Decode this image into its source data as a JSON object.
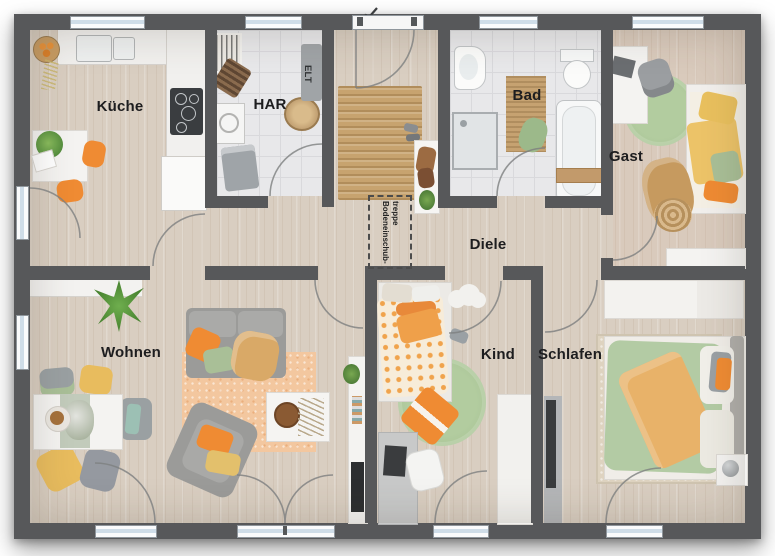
{
  "plan": {
    "type": "floor-plan-top-view",
    "rooms": {
      "kueche": "Küche",
      "har": "HAR",
      "bad": "Bad",
      "gast": "Gast",
      "diele": "Diele",
      "wohnen": "Wohnen",
      "kind": "Kind",
      "schlafen": "Schlafen"
    },
    "fixtures": {
      "elt": "ELT",
      "attic_line1": "Bodeneinschub-",
      "attic_line2": "treppe"
    },
    "palette": {
      "wall": "#57585a",
      "wood_floor": "#d9cec1",
      "tile_floor": "#e8e8ea",
      "accent_orange": "#ef8b33",
      "accent_yellow": "#e8bc5e",
      "accent_green": "#a9bf97",
      "rug_peach": "#f3c79f",
      "rug_jute": "#c7a36f"
    }
  }
}
